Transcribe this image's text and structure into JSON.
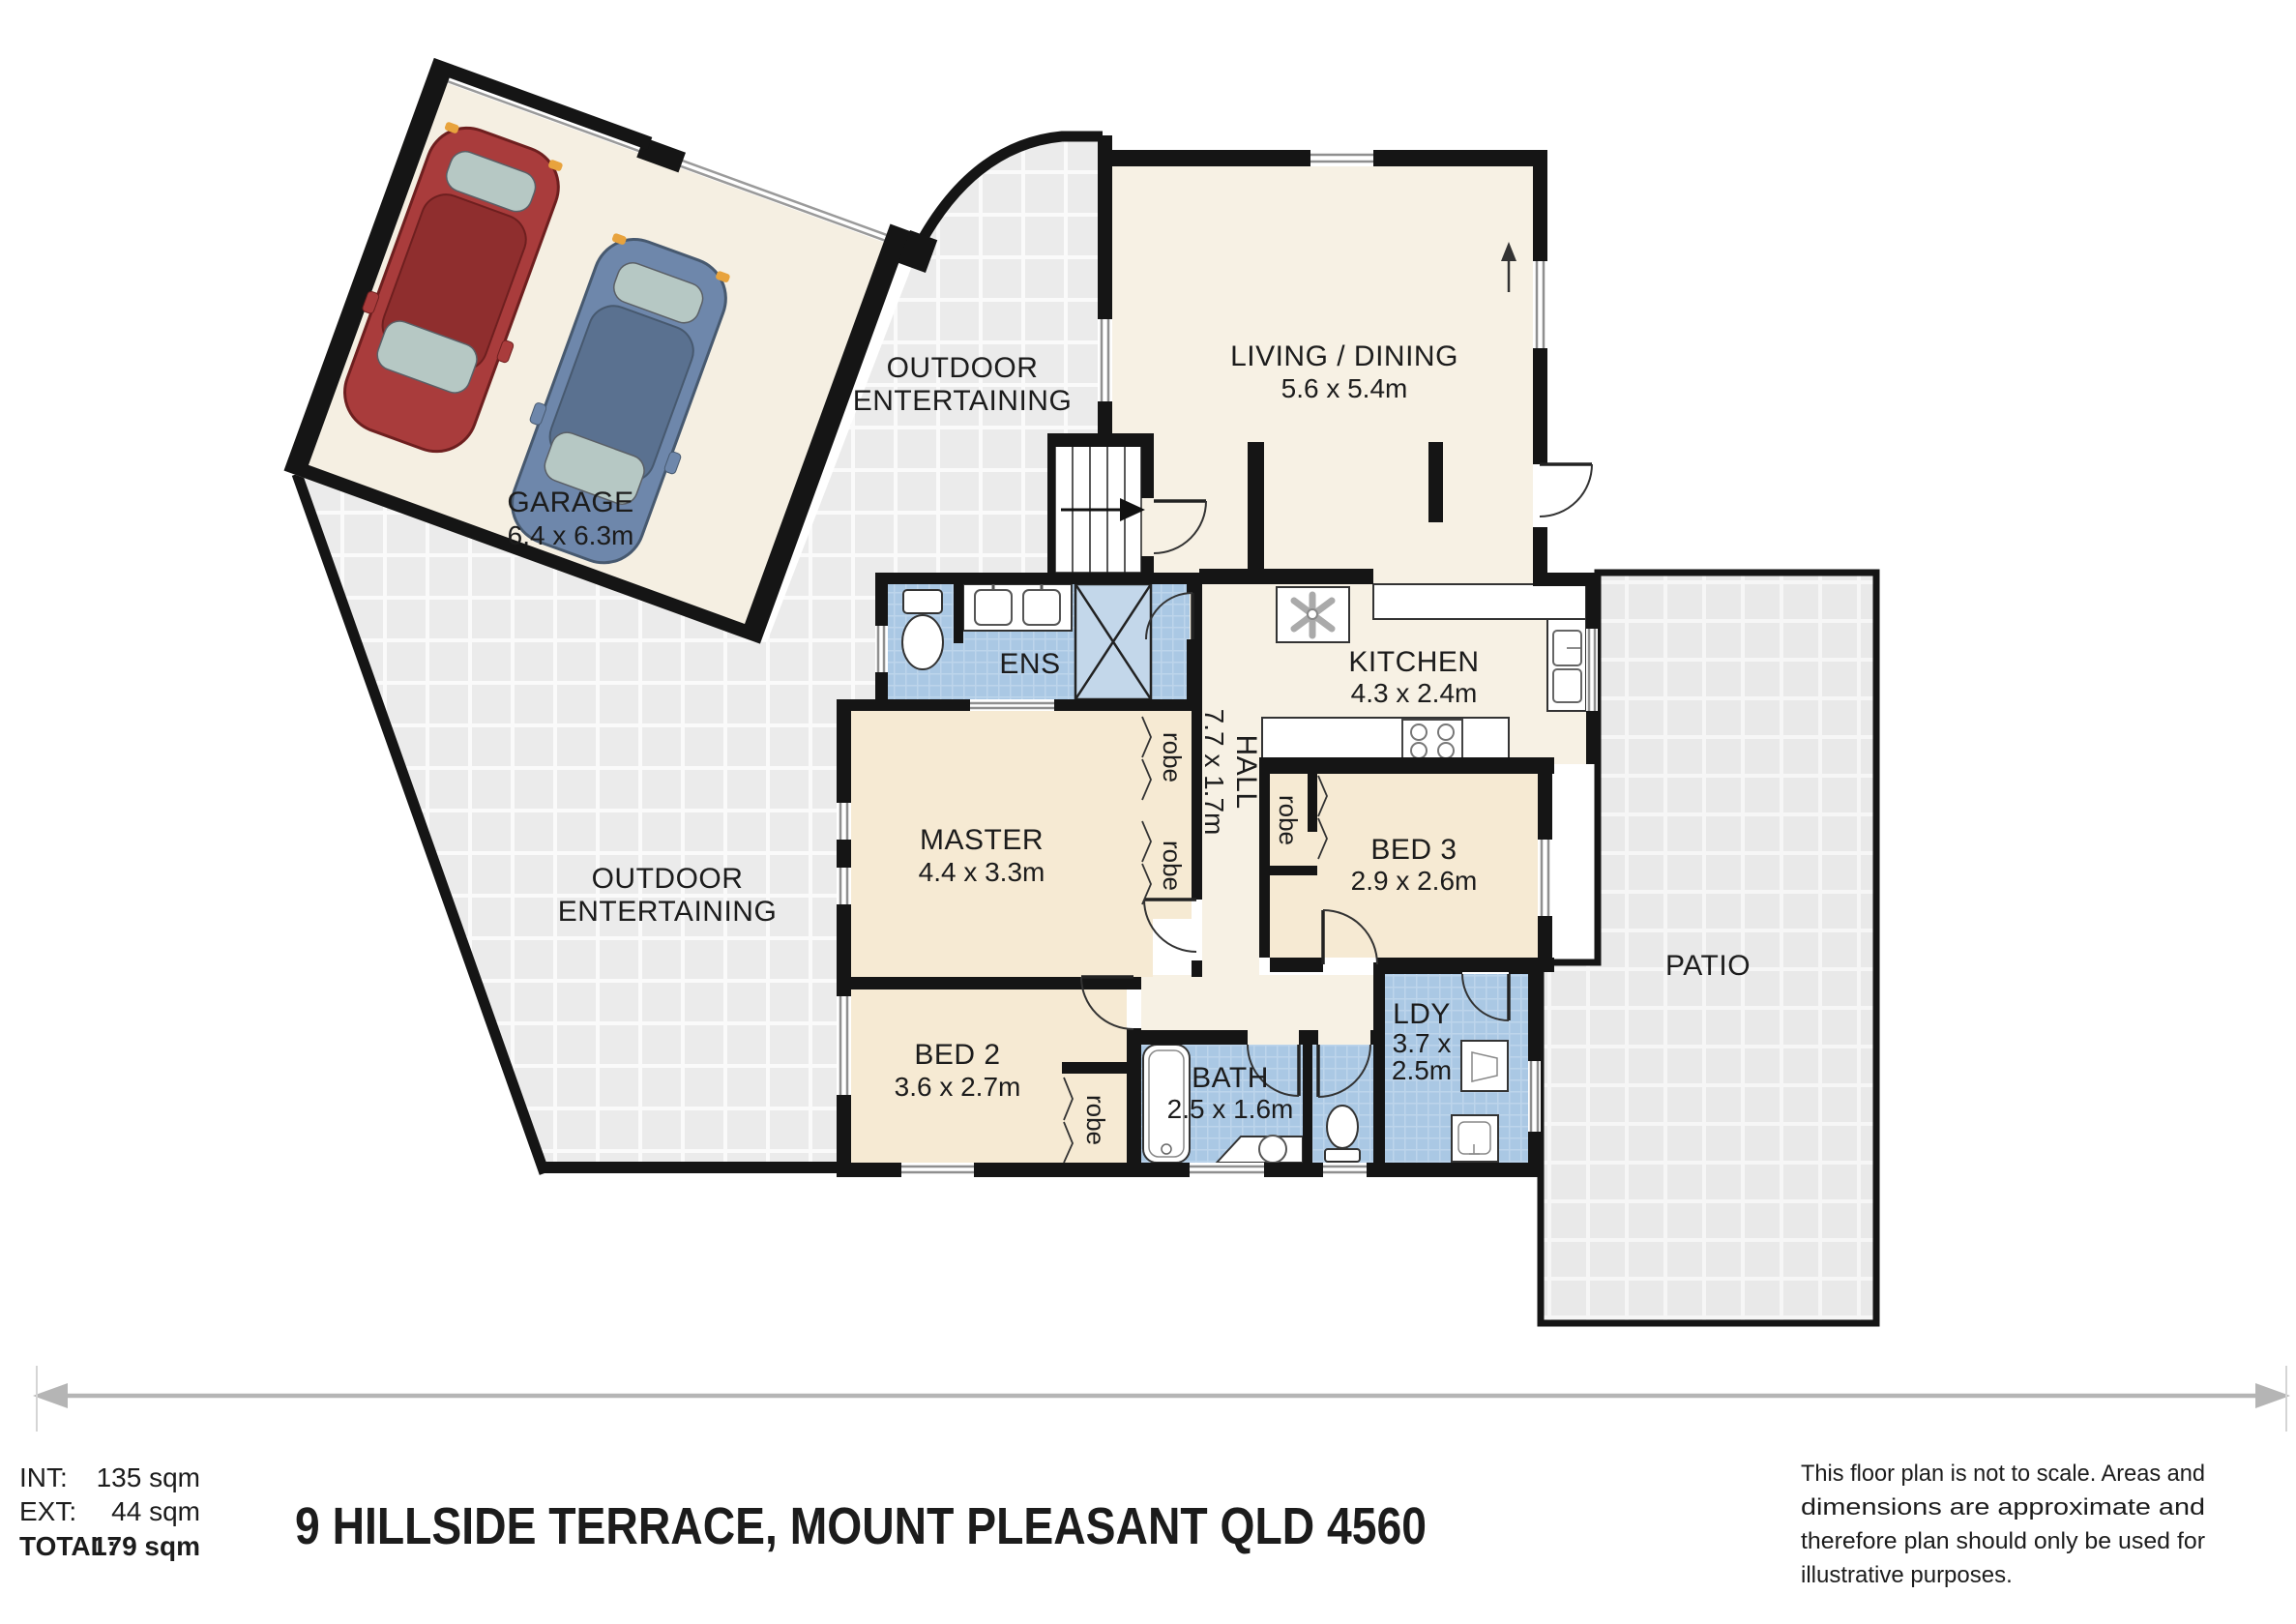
{
  "colors": {
    "wall": "#151515",
    "wet_area_blue": "#aac8e4",
    "room_cream": "#f7f1e4",
    "bedroom_cream": "#f6ead3",
    "outdoor_tile": "#ebebeb",
    "patio_tile": "#e9e9e9",
    "car_red": "#a93c3c",
    "car_blue": "#6e87ab"
  },
  "plan": {
    "garage": {
      "name": "GARAGE",
      "dims": "6.4 x 6.3m"
    },
    "outdoor_top": {
      "line1": "OUTDOOR",
      "line2": "ENTERTAINING"
    },
    "outdoor_left": {
      "line1": "OUTDOOR",
      "line2": "ENTERTAINING"
    },
    "living": {
      "name": "LIVING / DINING",
      "dims": "5.6 x 5.4m"
    },
    "kitchen": {
      "name": "KITCHEN",
      "dims": "4.3 x 2.4m"
    },
    "hall": {
      "name": "HALL",
      "dims": "7.7 x 1.7m"
    },
    "ens": {
      "name": "ENS"
    },
    "master": {
      "name": "MASTER",
      "dims": "4.4 x 3.3m"
    },
    "bed3": {
      "name": "BED 3",
      "dims": "2.9 x 2.6m"
    },
    "bed2": {
      "name": "BED 2",
      "dims": "3.6 x 2.7m"
    },
    "bath": {
      "name": "BATH",
      "dims": "2.5 x 1.6m"
    },
    "ldy": {
      "name": "LDY",
      "dims1": "3.7 x",
      "dims2": "2.5m"
    },
    "patio": {
      "name": "PATIO"
    },
    "robe_label": "robe"
  },
  "summary": {
    "int_label": "INT:",
    "int_value": "135 sqm",
    "ext_label": "EXT:",
    "ext_value": "44 sqm",
    "total_label": "TOTAL:",
    "total_value": "179 sqm"
  },
  "title": "9 HILLSIDE TERRACE, MOUNT PLEASANT QLD 4560",
  "disclaimer": {
    "line1": "This floor plan is not to scale. Areas and",
    "line2": "dimensions are approximate and",
    "line3": "therefore plan should only be used for",
    "line4": "illustrative purposes."
  }
}
